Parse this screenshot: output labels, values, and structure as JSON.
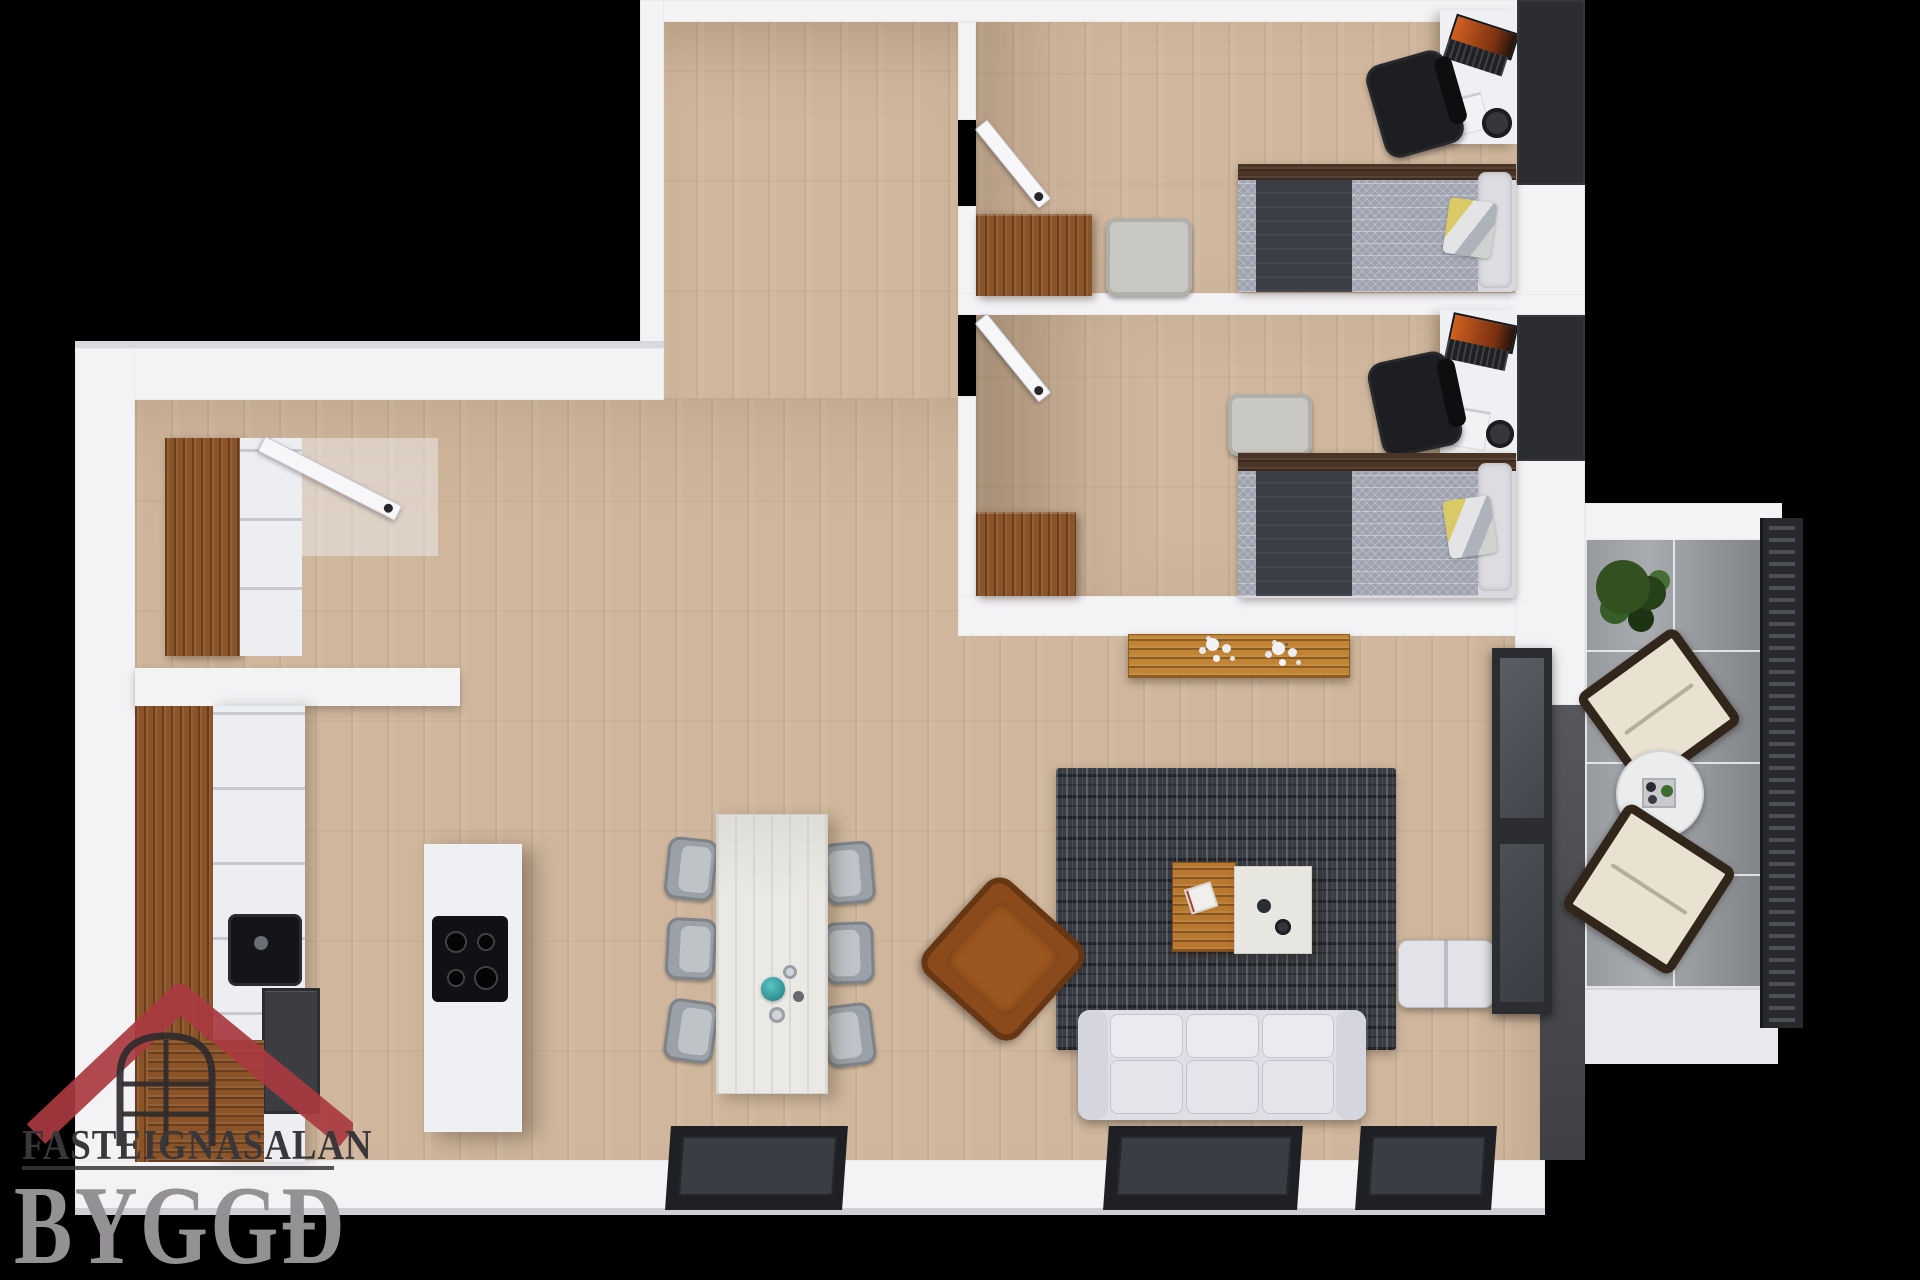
{
  "image_type": "3d-floor-plan-top-view",
  "watermark": {
    "agency_name": "FASTEIGNASALAN",
    "brand_name": "BYGGÐ",
    "icon": "house-roof-window-icon",
    "roof_color": "#a93a40",
    "agency_text_color": "#3a373a",
    "brand_text_color": "#949194"
  },
  "palette": {
    "background": "#000000",
    "walls": "#f3f2f5",
    "floor_wood": "#cfb69c",
    "cabinet_walnut": "#8a5428",
    "console_wood": "#c08434",
    "dark_furniture": "#2b2d32",
    "rug": "#393c43",
    "sofa": "#e0e1e7",
    "leather_armchair": "#8a4a1c",
    "balcony_tile": "#a8abaf",
    "bedding_herringbone": "#9fa3b0",
    "accent_teal": "#38a9ab",
    "laptop_screen": "#c2571c"
  },
  "scene": {
    "rooms": [
      {
        "name": "hallway"
      },
      {
        "name": "bedroom-1",
        "furniture": [
          "white desk with laptop and papers",
          "black office chair",
          "dark wardrobe",
          "single bed with herringbone duvet, dark throw, yellow-grey pillow",
          "walnut dresser",
          "grey armchair",
          "open door"
        ]
      },
      {
        "name": "bedroom-2",
        "furniture": [
          "white desk with laptop and papers",
          "black office chair",
          "dark wardrobe",
          "single bed with herringbone duvet, dark throw, yellow-grey pillow",
          "walnut dresser",
          "grey armchair",
          "open door"
        ]
      },
      {
        "name": "kitchen",
        "furniture": [
          "walnut counter run",
          "white cabinet fronts",
          "black sink",
          "oven unit",
          "white island with black cooktop"
        ]
      },
      {
        "name": "dining-area",
        "furniture": [
          "white marble table",
          "six grey shell chairs",
          "teal bowl",
          "glasses"
        ]
      },
      {
        "name": "living-room",
        "furniture": [
          "orange wood console with white flowers",
          "dark patterned rug",
          "cognac leather armchair",
          "wood coffee table with book",
          "marble side table with cups",
          "white three-seat sofa",
          "white ottoman",
          "dark media / fireplace unit"
        ]
      },
      {
        "name": "balcony",
        "furniture": [
          "potted plant",
          "two lounge chairs",
          "round coffee table with tray",
          "slatted dark railing"
        ]
      }
    ],
    "entry": [
      "entrance door",
      "hall closet with walnut panel and white drawers"
    ]
  }
}
